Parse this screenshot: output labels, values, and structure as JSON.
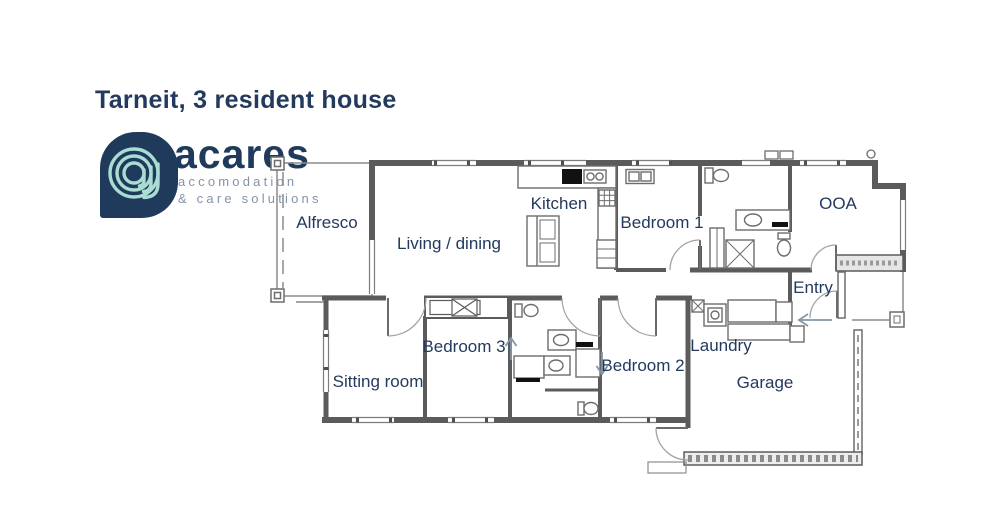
{
  "header": {
    "title": "Tarneit, 3 resident house"
  },
  "logo": {
    "brand": "acares",
    "tagline_line1": "accomodation",
    "tagline_line2": "& care solutions"
  },
  "colors": {
    "navy": "#203a5c",
    "label_navy": "#24395e",
    "logo_mint": "#a9dcd3",
    "tagline_gray": "#8494a6",
    "wall_dark": "#5b5b5b",
    "thin_line": "#8c8c8c",
    "arc_gray": "#a3a3a3",
    "arrow_gray": "#8496a6"
  },
  "plan": {
    "rooms": [
      {
        "id": "alfresco",
        "label": "Alfresco"
      },
      {
        "id": "living-dining",
        "label": "Living / dining"
      },
      {
        "id": "kitchen",
        "label": "Kitchen"
      },
      {
        "id": "bedroom-1",
        "label": "Bedroom 1"
      },
      {
        "id": "ooa",
        "label": "OOA"
      },
      {
        "id": "entry",
        "label": "Entry"
      },
      {
        "id": "bedroom-3",
        "label": "Bedroom 3"
      },
      {
        "id": "sitting-room",
        "label": "Sitting room"
      },
      {
        "id": "bedroom-2",
        "label": "Bedroom 2"
      },
      {
        "id": "laundry",
        "label": "Laundry"
      },
      {
        "id": "garage",
        "label": "Garage"
      }
    ],
    "annotations": {
      "bedroom3_arrow": "up",
      "bedroom2_arrow": "down",
      "entry_arrow": "left"
    }
  }
}
